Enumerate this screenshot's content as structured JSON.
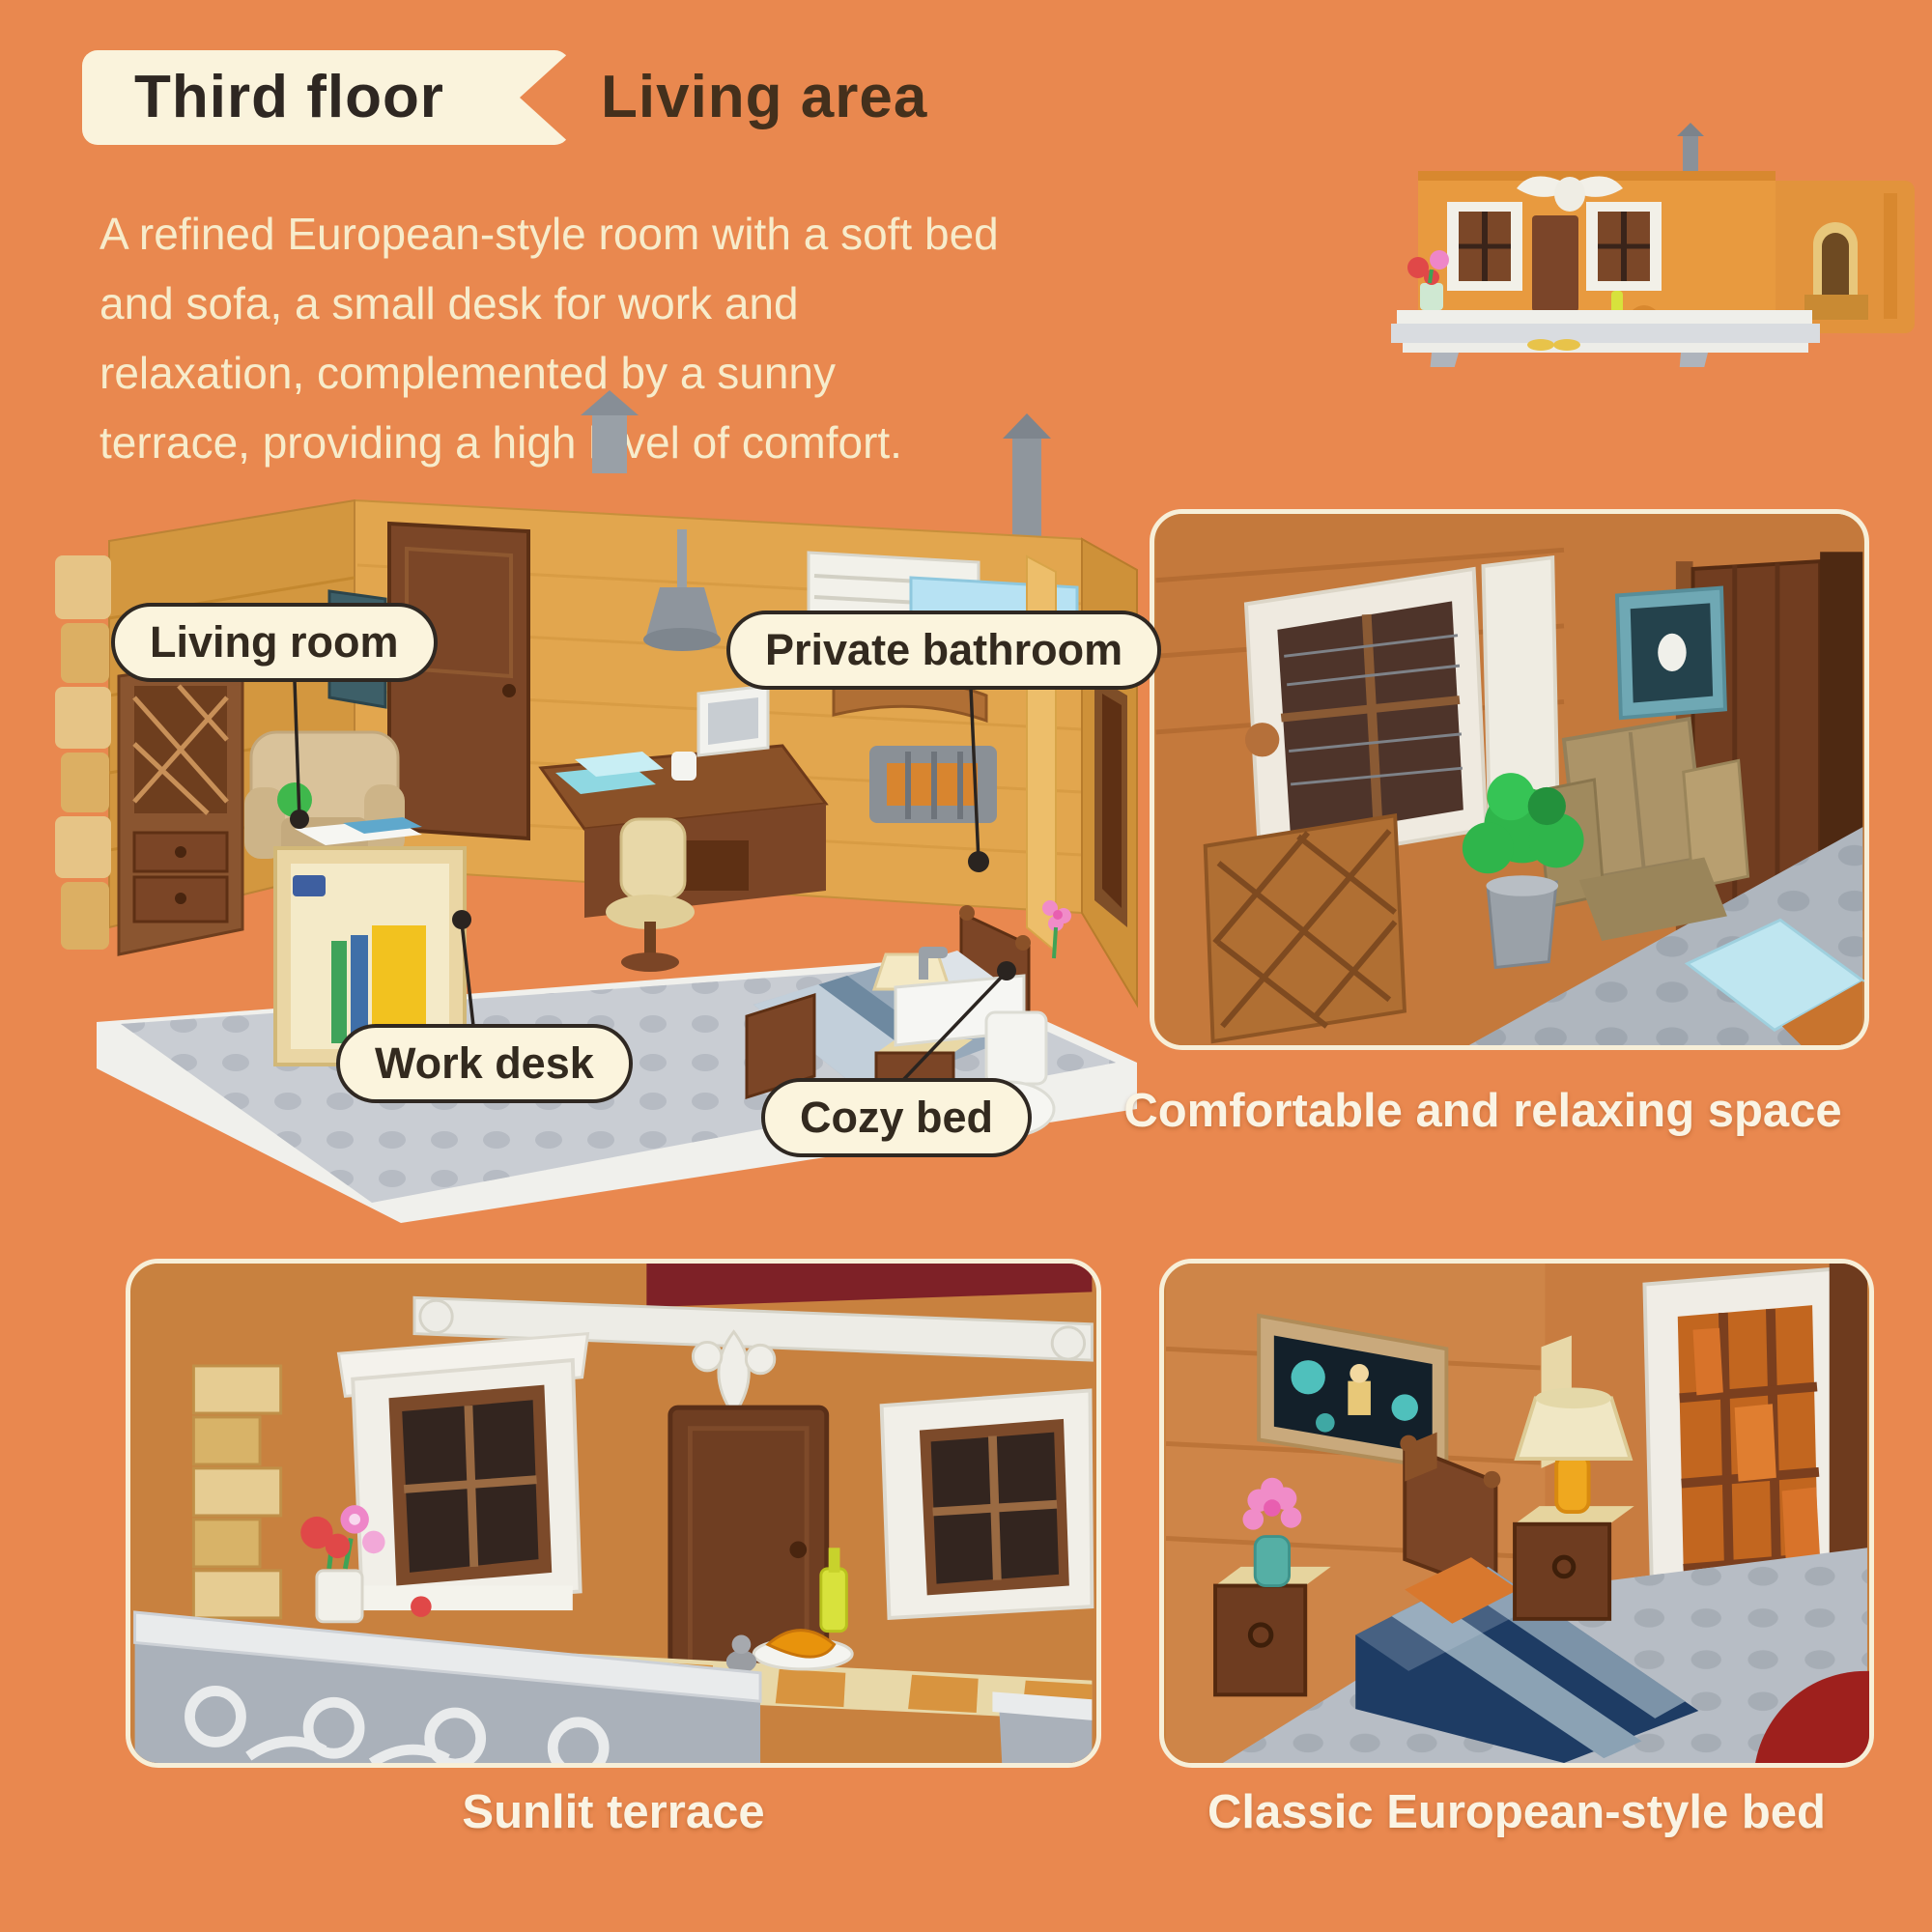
{
  "colors": {
    "background": "#E9884F",
    "ribbon_bg": "#FAF3DC",
    "heading_text": "#2E2722",
    "area_text": "#44301C",
    "paragraph_text": "#F7ECCB",
    "pill_bg": "#FBF4DD",
    "pill_border": "#2F2822",
    "pill_text": "#332A1F",
    "caption_text": "#FAF4E4",
    "photo_border": "#F7EFD8"
  },
  "header": {
    "floor_label": "Third floor",
    "area_label": "Living area"
  },
  "description_lines": [
    "A refined European-style room with a soft bed",
    "and sofa, a small desk for work and",
    "relaxation, complemented by a sunny",
    "terrace, providing a high level of comfort."
  ],
  "main_photo": {
    "callouts": [
      {
        "label": "Living room"
      },
      {
        "label": "Private bathroom"
      },
      {
        "label": "Work desk"
      },
      {
        "label": "Cozy bed"
      }
    ]
  },
  "detail_photos": {
    "comfort": {
      "caption": "Comfortable and relaxing space"
    },
    "terrace": {
      "caption": "Sunlit terrace"
    },
    "bed": {
      "caption": "Classic European-style bed"
    }
  }
}
